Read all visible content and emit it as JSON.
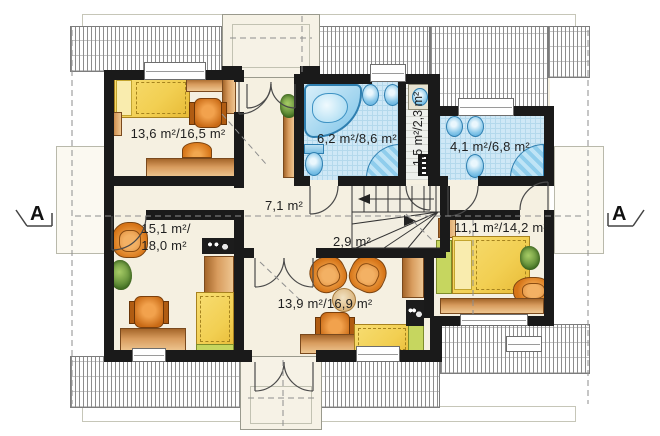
{
  "plan": {
    "type": "attic-floor-plan",
    "section_markers": {
      "left": "A",
      "right": "A"
    },
    "rooms": {
      "bedroom_top_left": {
        "label": "13,6 m²/16,5 m²"
      },
      "bathroom_main": {
        "label": "6,2 m²/8,6 m²"
      },
      "closet": {
        "label": "1,5 m²/2,3 m²"
      },
      "bathroom_small": {
        "label": "4,1 m²/6,8 m²"
      },
      "hall": {
        "label": "7,1 m²"
      },
      "staircase": {
        "label": "2,9 m²"
      },
      "bedroom_bottom_left": {
        "label_line1": "15,1 m²/",
        "label_line2": "18,0 m²"
      },
      "room_bottom_middle": {
        "label": "13,9 m²/16,9 m²"
      },
      "bedroom_bottom_right": {
        "label": "11,1 m²/14,2 m²"
      }
    },
    "colors": {
      "wall": "#1a1a1a",
      "floor": "#f5f0e1",
      "tile": "#cfe8f6",
      "fixture_blue": "#85c6e9",
      "bed_yellow": "#f2cf52",
      "wood": "#c98a49",
      "chair_orange": "#d67417",
      "accent_green": "#c6d65f"
    }
  }
}
